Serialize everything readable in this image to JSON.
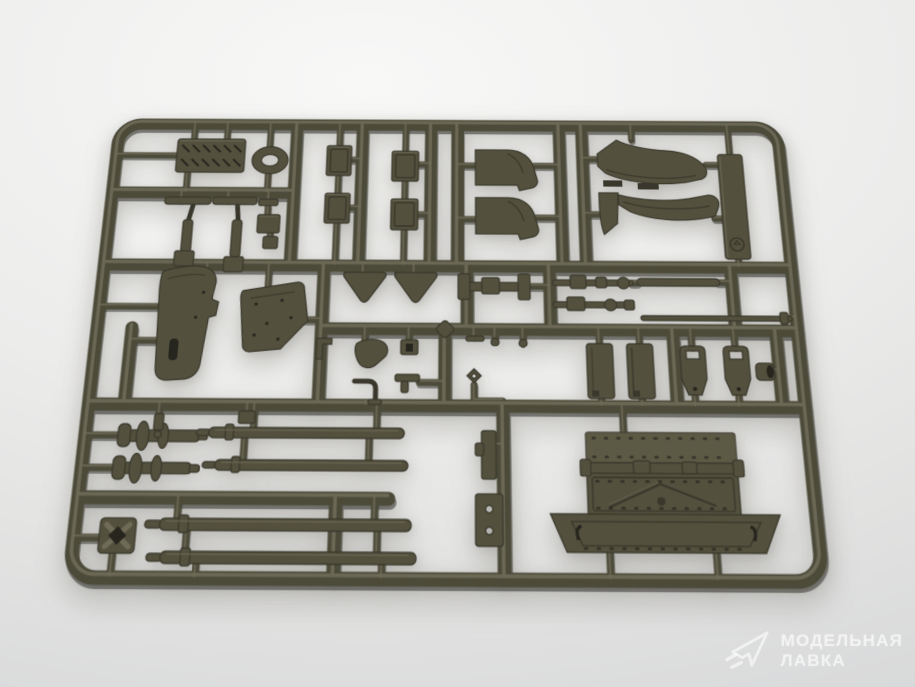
{
  "scene": {
    "subject": "Olive-drab injection-molded model kit parts sprue photographed on a light gray studio background",
    "sprue_color_name": "olive drab",
    "parts_include": "track section, oval ring, hatches, fenders, armor plates, levers, linkages, gun barrels, axles, wheel hubs, riveted hull box"
  },
  "colors": {
    "runner_base": "#4c4a39",
    "runner_shadow": "#31302a",
    "runner_highlight": "#716e5a",
    "plastic_base": "#53503d",
    "plastic_dark": "#3a382c",
    "plastic_deep": "#26251e",
    "plastic_light": "#6e6b57",
    "bg_light": "#f8f8f7",
    "bg_mid": "#ececeb",
    "bg_dark": "#d6d7d8",
    "watermark_color": "rgba(255,255,255,0.58)"
  },
  "watermark": {
    "logo": "paper-plane-icon",
    "line1": "МОДЕЛЬНАЯ",
    "line2": "ЛАВКА"
  }
}
